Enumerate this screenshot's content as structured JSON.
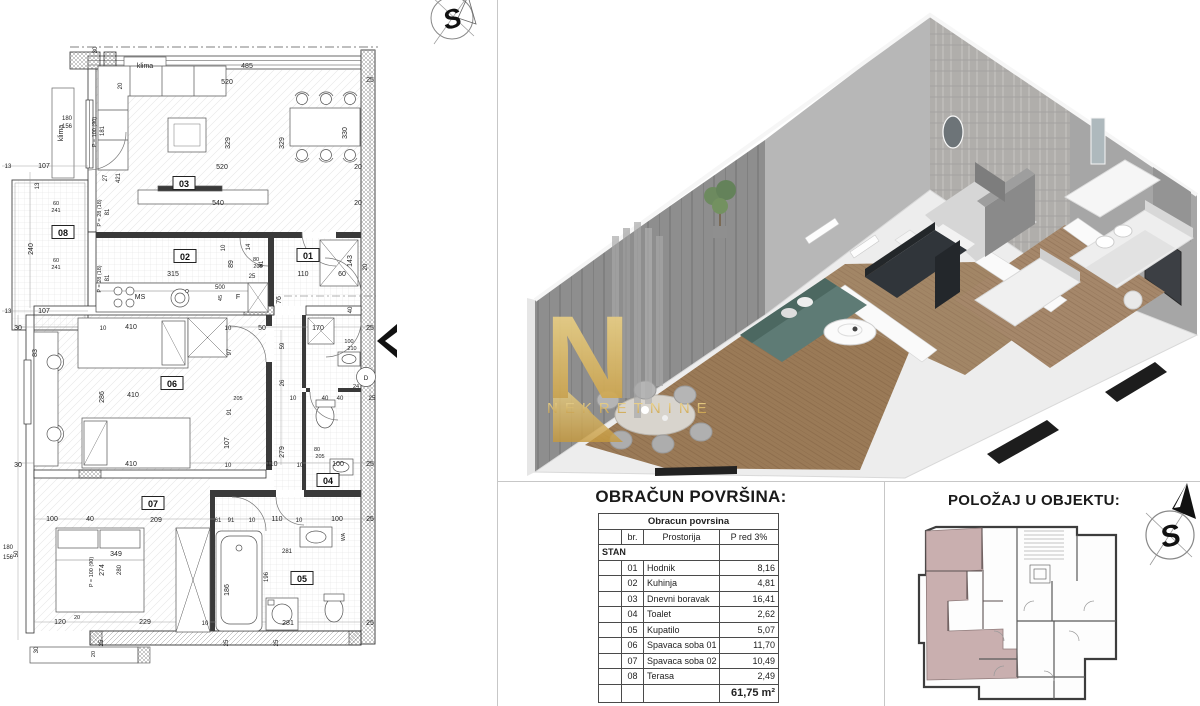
{
  "meta": {
    "bg": "#ffffff",
    "divider": "#c7c7c7"
  },
  "compass": {
    "letter": "S"
  },
  "watermark": {
    "letter": "N",
    "text": "NEKRETNINE",
    "gold": "#d9ab4e"
  },
  "sections": {
    "area_table": {
      "title": "OBRAČUN POVRŠINA:",
      "table_title": "Obracun povrsina",
      "columns": [
        "br.",
        "Prostorija",
        "P red 3%"
      ],
      "group_label": "STAN",
      "rows": [
        {
          "br": "01",
          "name": "Hodnik",
          "area": "8,16"
        },
        {
          "br": "02",
          "name": "Kuhinja",
          "area": "4,81"
        },
        {
          "br": "03",
          "name": "Dnevni boravak",
          "area": "16,41"
        },
        {
          "br": "04",
          "name": "Toalet",
          "area": "2,62"
        },
        {
          "br": "05",
          "name": "Kupatilo",
          "area": "5,07"
        },
        {
          "br": "06",
          "name": "Spavaca soba 01",
          "area": "11,70"
        },
        {
          "br": "07",
          "name": "Spavaca soba 02",
          "area": "10,49"
        },
        {
          "br": "08",
          "name": "Terasa",
          "area": "2,49"
        }
      ],
      "total": "61,75 m²"
    },
    "position": {
      "title": "POLOŽAJ U OBJEKTU:",
      "highlight_color": "#c9afaf"
    }
  },
  "floorplan": {
    "room_boxes": [
      {
        "n": "03",
        "x": 184,
        "y": 186
      },
      {
        "n": "02",
        "x": 185,
        "y": 259
      },
      {
        "n": "01",
        "x": 308,
        "y": 258
      },
      {
        "n": "08",
        "x": 63,
        "y": 235
      },
      {
        "n": "06",
        "x": 172,
        "y": 386
      },
      {
        "n": "04",
        "x": 328,
        "y": 483
      },
      {
        "n": "07",
        "x": 153,
        "y": 506
      },
      {
        "n": "05",
        "x": 302,
        "y": 581
      }
    ],
    "labels": [
      {
        "t": "klima",
        "x": 145,
        "y": 68
      },
      {
        "t": "485",
        "x": 247,
        "y": 68
      },
      {
        "t": "520",
        "x": 227,
        "y": 84
      },
      {
        "t": "30",
        "x": 97,
        "y": 50,
        "r": -90,
        "s": 6
      },
      {
        "t": "20",
        "x": 122,
        "y": 86,
        "r": -90,
        "s": 6
      },
      {
        "t": "329",
        "x": 230,
        "y": 143,
        "r": -90
      },
      {
        "t": "329",
        "x": 284,
        "y": 143,
        "r": -90
      },
      {
        "t": "330",
        "x": 347,
        "y": 133,
        "r": -90
      },
      {
        "t": "25",
        "x": 370,
        "y": 82
      },
      {
        "t": "520",
        "x": 222,
        "y": 169
      },
      {
        "t": "20",
        "x": 358,
        "y": 169
      },
      {
        "t": "540",
        "x": 218,
        "y": 205
      },
      {
        "t": "20",
        "x": 358,
        "y": 205
      },
      {
        "t": "27",
        "x": 107,
        "y": 178,
        "r": -90,
        "s": 6
      },
      {
        "t": "421",
        "x": 120,
        "y": 178,
        "r": -90,
        "s": 6
      },
      {
        "t": "P = 100 (90)",
        "x": 96,
        "y": 132,
        "r": -90,
        "s": 5.5
      },
      {
        "t": "181",
        "x": 104,
        "y": 131,
        "r": -90,
        "s": 6
      },
      {
        "t": "180",
        "x": 67,
        "y": 120,
        "s": 6
      },
      {
        "t": "156",
        "x": 67,
        "y": 128,
        "s": 6
      },
      {
        "t": "klima",
        "x": 63,
        "y": 133,
        "r": -90
      },
      {
        "t": "13",
        "x": 8,
        "y": 168,
        "s": 6
      },
      {
        "t": "107",
        "x": 44,
        "y": 168
      },
      {
        "t": "13",
        "x": 39,
        "y": 186,
        "r": -90,
        "s": 6
      },
      {
        "t": "60",
        "x": 56,
        "y": 205,
        "s": 5.5
      },
      {
        "t": "241",
        "x": 56,
        "y": 212,
        "s": 5.5
      },
      {
        "t": "240",
        "x": 33,
        "y": 249,
        "r": -90
      },
      {
        "t": "60",
        "x": 56,
        "y": 262,
        "s": 5.5
      },
      {
        "t": "241",
        "x": 56,
        "y": 269,
        "s": 5.5
      },
      {
        "t": "107",
        "x": 44,
        "y": 313
      },
      {
        "t": "13",
        "x": 8,
        "y": 313,
        "s": 6
      },
      {
        "t": "P = 28 (18)",
        "x": 101,
        "y": 213,
        "r": -90,
        "s": 5.5
      },
      {
        "t": "81",
        "x": 109,
        "y": 212,
        "r": -90,
        "s": 6
      },
      {
        "t": "P = 28 (18)",
        "x": 101,
        "y": 279,
        "r": -90,
        "s": 5.5
      },
      {
        "t": "81",
        "x": 109,
        "y": 278,
        "r": -90,
        "s": 6
      },
      {
        "t": "315",
        "x": 173,
        "y": 276
      },
      {
        "t": "89",
        "x": 233,
        "y": 264,
        "r": -90
      },
      {
        "t": "10",
        "x": 225,
        "y": 248,
        "r": -90,
        "s": 6
      },
      {
        "t": "80",
        "x": 256,
        "y": 261,
        "s": 5.5
      },
      {
        "t": "205",
        "x": 258,
        "y": 268,
        "s": 5.5
      },
      {
        "t": "25",
        "x": 252,
        "y": 278,
        "s": 6
      },
      {
        "t": "110",
        "x": 303,
        "y": 276
      },
      {
        "t": "81",
        "x": 263,
        "y": 264,
        "r": -90,
        "s": 6
      },
      {
        "t": "14",
        "x": 250,
        "y": 247,
        "r": -90,
        "s": 6
      },
      {
        "t": "143",
        "x": 352,
        "y": 261,
        "r": -90
      },
      {
        "t": "60",
        "x": 342,
        "y": 276
      },
      {
        "t": "20",
        "x": 367,
        "y": 267,
        "r": -90,
        "s": 6
      },
      {
        "t": "500",
        "x": 220,
        "y": 289,
        "s": 6
      },
      {
        "t": "45",
        "x": 222,
        "y": 298,
        "r": -90,
        "s": 5.5
      },
      {
        "t": "F",
        "x": 238,
        "y": 299,
        "s": 7
      },
      {
        "t": "MS",
        "x": 140,
        "y": 299,
        "s": 7
      },
      {
        "t": "76",
        "x": 281,
        "y": 300,
        "r": -90
      },
      {
        "t": "40",
        "x": 352,
        "y": 310,
        "r": -90,
        "s": 6
      },
      {
        "t": "30",
        "x": 18,
        "y": 330
      },
      {
        "t": "10",
        "x": 103,
        "y": 330,
        "s": 6
      },
      {
        "t": "410",
        "x": 131,
        "y": 329
      },
      {
        "t": "10",
        "x": 228,
        "y": 330,
        "s": 6
      },
      {
        "t": "50",
        "x": 262,
        "y": 330
      },
      {
        "t": "170",
        "x": 318,
        "y": 330
      },
      {
        "t": "25",
        "x": 370,
        "y": 330
      },
      {
        "t": "100",
        "x": 349,
        "y": 343,
        "s": 5.5
      },
      {
        "t": "210",
        "x": 352,
        "y": 350,
        "s": 5.5
      },
      {
        "t": "59",
        "x": 284,
        "y": 346,
        "r": -90,
        "s": 6
      },
      {
        "t": "26",
        "x": 284,
        "y": 383,
        "r": -90,
        "s": 6
      },
      {
        "t": "279",
        "x": 284,
        "y": 452,
        "r": -90
      },
      {
        "t": "83",
        "x": 37,
        "y": 353,
        "r": -90
      },
      {
        "t": "286",
        "x": 104,
        "y": 397,
        "r": -90
      },
      {
        "t": "410",
        "x": 133,
        "y": 397
      },
      {
        "t": "97",
        "x": 231,
        "y": 352,
        "r": -90,
        "s": 6
      },
      {
        "t": "91",
        "x": 231,
        "y": 412,
        "r": -90,
        "s": 6
      },
      {
        "t": "205",
        "x": 238,
        "y": 400,
        "s": 5.5
      },
      {
        "t": "107",
        "x": 229,
        "y": 443,
        "r": -90
      },
      {
        "t": "40",
        "x": 325,
        "y": 400,
        "s": 6
      },
      {
        "t": "40",
        "x": 340,
        "y": 400,
        "s": 6
      },
      {
        "t": "10",
        "x": 293,
        "y": 400,
        "s": 6
      },
      {
        "t": "25",
        "x": 372,
        "y": 400,
        "s": 6
      },
      {
        "t": "24",
        "x": 356,
        "y": 388,
        "s": 5.5
      },
      {
        "t": "80",
        "x": 317,
        "y": 451,
        "s": 5.5
      },
      {
        "t": "205",
        "x": 320,
        "y": 458,
        "s": 5.5
      },
      {
        "t": "615",
        "x": 335,
        "y": 480,
        "r": -90,
        "s": 6
      },
      {
        "t": "D",
        "x": 366,
        "y": 380,
        "s": 6.5
      },
      {
        "t": "30",
        "x": 18,
        "y": 467
      },
      {
        "t": "410",
        "x": 131,
        "y": 466
      },
      {
        "t": "10",
        "x": 228,
        "y": 467,
        "s": 6
      },
      {
        "t": "110",
        "x": 272,
        "y": 466
      },
      {
        "t": "10",
        "x": 300,
        "y": 467,
        "s": 6
      },
      {
        "t": "100",
        "x": 338,
        "y": 466
      },
      {
        "t": "25",
        "x": 370,
        "y": 466
      },
      {
        "t": "100",
        "x": 52,
        "y": 521
      },
      {
        "t": "40",
        "x": 90,
        "y": 521
      },
      {
        "t": "209",
        "x": 156,
        "y": 522
      },
      {
        "t": "61",
        "x": 218,
        "y": 522,
        "s": 6
      },
      {
        "t": "91",
        "x": 231,
        "y": 522,
        "s": 6
      },
      {
        "t": "10",
        "x": 252,
        "y": 522,
        "s": 6
      },
      {
        "t": "110",
        "x": 277,
        "y": 521
      },
      {
        "t": "10",
        "x": 299,
        "y": 522,
        "s": 6
      },
      {
        "t": "100",
        "x": 337,
        "y": 521
      },
      {
        "t": "25",
        "x": 370,
        "y": 521
      },
      {
        "t": "349",
        "x": 116,
        "y": 556
      },
      {
        "t": "274",
        "x": 104,
        "y": 570,
        "r": -90
      },
      {
        "t": "280",
        "x": 121,
        "y": 570,
        "r": -90,
        "s": 6
      },
      {
        "t": "186",
        "x": 229,
        "y": 590,
        "r": -90
      },
      {
        "t": "196",
        "x": 268,
        "y": 577,
        "r": -90,
        "s": 6
      },
      {
        "t": "281",
        "x": 287,
        "y": 553,
        "s": 6
      },
      {
        "t": "WA",
        "x": 345,
        "y": 537,
        "r": -90,
        "s": 5
      },
      {
        "t": "180",
        "x": 8,
        "y": 549,
        "s": 6
      },
      {
        "t": "156",
        "x": 8,
        "y": 559,
        "s": 6
      },
      {
        "t": "50",
        "x": 18,
        "y": 554,
        "r": -90,
        "s": 6
      },
      {
        "t": "P = 100 (90)",
        "x": 93,
        "y": 572,
        "r": -90,
        "s": 5.5
      },
      {
        "t": "120",
        "x": 60,
        "y": 624
      },
      {
        "t": "20",
        "x": 77,
        "y": 619,
        "s": 5.5
      },
      {
        "t": "229",
        "x": 145,
        "y": 624
      },
      {
        "t": "10",
        "x": 205,
        "y": 625,
        "s": 6
      },
      {
        "t": "281",
        "x": 288,
        "y": 625
      },
      {
        "t": "25",
        "x": 370,
        "y": 625
      },
      {
        "t": "25",
        "x": 103,
        "y": 643,
        "r": -90,
        "s": 6
      },
      {
        "t": "25",
        "x": 228,
        "y": 643,
        "r": -90,
        "s": 6
      },
      {
        "t": "25",
        "x": 278,
        "y": 643,
        "r": -90,
        "s": 6
      },
      {
        "t": "30",
        "x": 38,
        "y": 650,
        "r": -90,
        "s": 6
      },
      {
        "t": "20",
        "x": 95,
        "y": 654,
        "r": -90,
        "s": 5.5
      }
    ]
  }
}
